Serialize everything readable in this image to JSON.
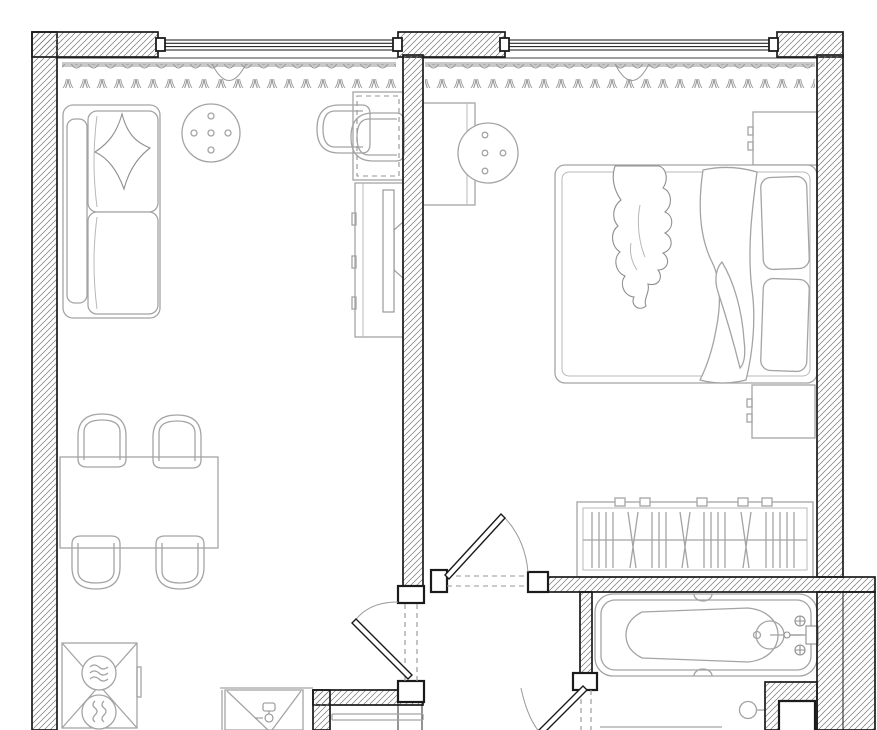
{
  "plan": {
    "label": "Apartment floor plan, top view, black and white architectural drawing",
    "text_visible_on_image": "none"
  },
  "canvas": {
    "width": 877,
    "height": 730
  },
  "palette": {
    "background": "#ffffff",
    "wall_line": "#1b1b1b",
    "hatch_line": "#767676",
    "furniture_line": "#a4a4a4",
    "furniture_dark": "#8f8f8f",
    "curtain": "#9a9a9a",
    "curtain_rod": "#c9c9c9",
    "dashed_opening": "#949494"
  },
  "rooms": [
    {
      "id": "living-kitchen",
      "label": "Living room with kitchen",
      "furniture": [
        "sofa with throw pillow",
        "round coffee table with dots",
        "desk with two armchairs",
        "tv console with tv",
        "dining table",
        "dining chair x4",
        "stove-washer unit with two burners",
        "kitchen sink cabinet with faucet"
      ]
    },
    {
      "id": "bedroom",
      "label": "Bedroom",
      "furniture": [
        "dressing desk",
        "round stool with dots",
        "nightstand top",
        "double bed with two pillows, blanket and draped throw",
        "nightstand bottom",
        "open wardrobe with clothes hangers"
      ]
    },
    {
      "id": "bathroom",
      "label": "Bathroom",
      "furniture": [
        "bathtub with drain and wall faucet",
        "towel ring",
        "counter edge cut by image border"
      ]
    },
    {
      "id": "hallway",
      "label": "Hallway",
      "furniture": []
    }
  ],
  "openings": {
    "window_count": 2,
    "curtain_count": 2,
    "door_count": 3,
    "windows": [
      {
        "room": "living-kitchen",
        "side": "top"
      },
      {
        "room": "bedroom",
        "side": "top"
      }
    ],
    "doors": [
      {
        "between": "living-kitchen and hallway",
        "type": "swing"
      },
      {
        "between": "hallway and bedroom",
        "type": "swing"
      },
      {
        "between": "hallway and bathroom",
        "type": "swing, cut by image border"
      }
    ]
  }
}
